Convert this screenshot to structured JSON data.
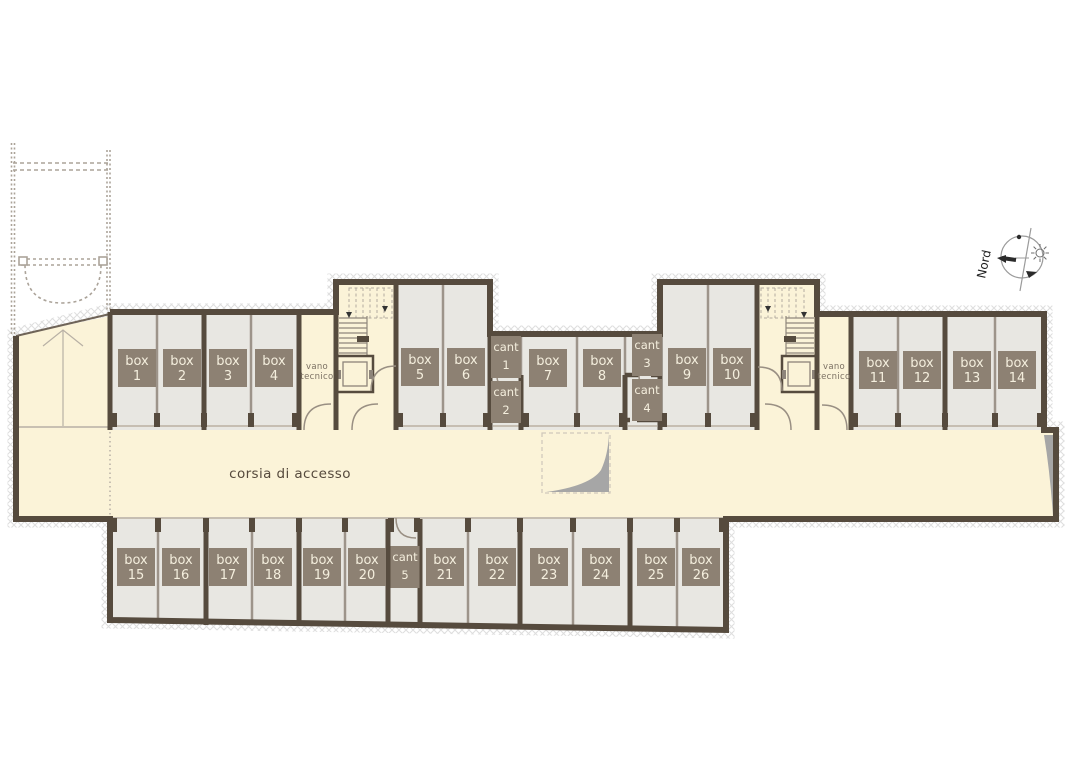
{
  "labels": {
    "corridor": "corsia di accesso",
    "north": "Nord",
    "technical_room_line1": "vano",
    "technical_room_line2": "tecnico"
  },
  "colors": {
    "wall": "#564b3e",
    "thin_wall": "#9d948a",
    "threshold": "#c6beb2",
    "circulation_fill": "#fbf3d8",
    "room_fill": "#e8e7e2",
    "label_bg": "#8d8173",
    "label_text": "#f4eedd",
    "hatch": "#dedede",
    "ramp_shadow": "#a6a6a6"
  },
  "rooms": [
    {
      "id": "box-1",
      "kind": "box",
      "line1": "box",
      "line2": "1"
    },
    {
      "id": "box-2",
      "kind": "box",
      "line1": "box",
      "line2": "2"
    },
    {
      "id": "box-3",
      "kind": "box",
      "line1": "box",
      "line2": "3"
    },
    {
      "id": "box-4",
      "kind": "box",
      "line1": "box",
      "line2": "4"
    },
    {
      "id": "box-5",
      "kind": "box",
      "line1": "box",
      "line2": "5"
    },
    {
      "id": "box-6",
      "kind": "box",
      "line1": "box",
      "line2": "6"
    },
    {
      "id": "cant-1",
      "kind": "cant",
      "line1": "cant",
      "line2": "1"
    },
    {
      "id": "cant-2",
      "kind": "cant",
      "line1": "cant",
      "line2": "2"
    },
    {
      "id": "box-7",
      "kind": "box",
      "line1": "box",
      "line2": "7"
    },
    {
      "id": "box-8",
      "kind": "box",
      "line1": "box",
      "line2": "8"
    },
    {
      "id": "cant-3",
      "kind": "cant",
      "line1": "cant",
      "line2": "3"
    },
    {
      "id": "cant-4",
      "kind": "cant",
      "line1": "cant",
      "line2": "4"
    },
    {
      "id": "box-9",
      "kind": "box",
      "line1": "box",
      "line2": "9"
    },
    {
      "id": "box-10",
      "kind": "box",
      "line1": "box",
      "line2": "10"
    },
    {
      "id": "box-11",
      "kind": "box",
      "line1": "box",
      "line2": "11"
    },
    {
      "id": "box-12",
      "kind": "box",
      "line1": "box",
      "line2": "12"
    },
    {
      "id": "box-13",
      "kind": "box",
      "line1": "box",
      "line2": "13"
    },
    {
      "id": "box-14",
      "kind": "box",
      "line1": "box",
      "line2": "14"
    },
    {
      "id": "box-15",
      "kind": "box",
      "line1": "box",
      "line2": "15"
    },
    {
      "id": "box-16",
      "kind": "box",
      "line1": "box",
      "line2": "16"
    },
    {
      "id": "box-17",
      "kind": "box",
      "line1": "box",
      "line2": "17"
    },
    {
      "id": "box-18",
      "kind": "box",
      "line1": "box",
      "line2": "18"
    },
    {
      "id": "box-19",
      "kind": "box",
      "line1": "box",
      "line2": "19"
    },
    {
      "id": "box-20",
      "kind": "box",
      "line1": "box",
      "line2": "20"
    },
    {
      "id": "cant-5",
      "kind": "cant",
      "line1": "cant",
      "line2": "5"
    },
    {
      "id": "box-21",
      "kind": "box",
      "line1": "box",
      "line2": "21"
    },
    {
      "id": "box-22",
      "kind": "box",
      "line1": "box",
      "line2": "22"
    },
    {
      "id": "box-23",
      "kind": "box",
      "line1": "box",
      "line2": "23"
    },
    {
      "id": "box-24",
      "kind": "box",
      "line1": "box",
      "line2": "24"
    },
    {
      "id": "box-25",
      "kind": "box",
      "line1": "box",
      "line2": "25"
    },
    {
      "id": "box-26",
      "kind": "box",
      "line1": "box",
      "line2": "26"
    }
  ]
}
